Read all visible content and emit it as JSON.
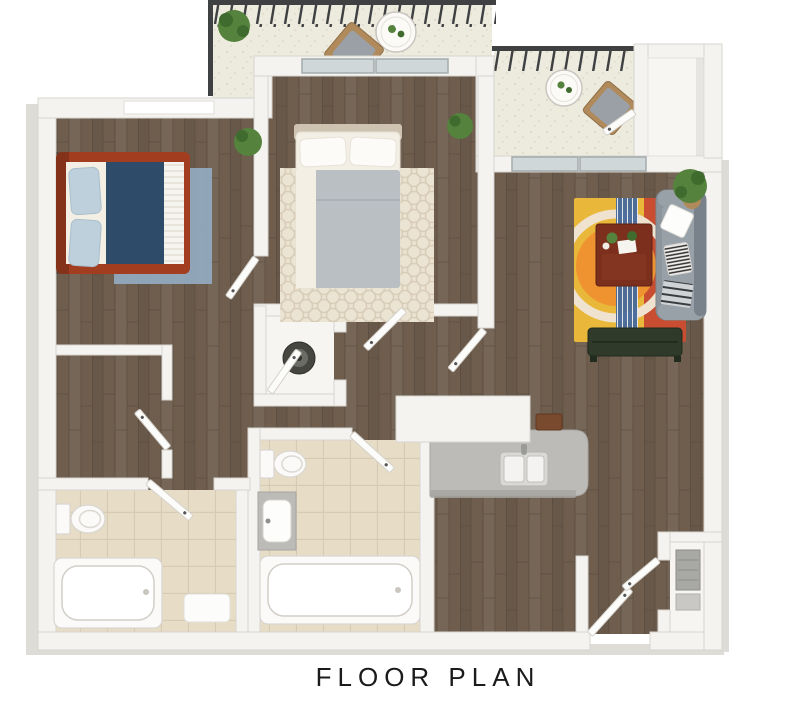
{
  "title": "FLOOR PLAN",
  "colors": {
    "wood": "#6f5e4e",
    "woodLine": "#57493d",
    "wall": "#f4f3f0",
    "wallEdge": "#d7d4cf",
    "skirt": "#dedcd7",
    "tile": "#e7ddc7",
    "tileLine": "#d6cbb2",
    "balconyFloor": "#edeade",
    "speckle": "#d2cdbc",
    "railing": "#3e4042",
    "glass": "#ccd4d6",
    "glassFrame": "#9ba4a6",
    "window": "#ffffff",
    "bedframe": "#a33d20",
    "navy": "#2e4c6a",
    "sheet": "#f3efe4",
    "pillowBlue": "#bdd0dc",
    "rugBlue": "#92a9be",
    "headboard": "#cdc3b0",
    "blanket": "#babfc4",
    "rugCream": "#ece4d3",
    "rugCreamLine": "#d8cdb8",
    "sofa": "#8d959c",
    "sofaDark": "#79828a",
    "sofaSeat": "#99a1a8",
    "zebra": "#2c2c2c",
    "rugYellow": "#e9b83a",
    "rugOrange": "#ee9330",
    "rugRed": "#c94e31",
    "rugStripe": "#46699b",
    "ringCream": "#efe3cf",
    "table": "#7c2f1d",
    "tableEdge": "#5e2314",
    "bench": "#2f3a2b",
    "benchEdge": "#212b1e",
    "counter": "#bcbbb7",
    "counterEdge": "#a6a5a1",
    "plant": "#55823c",
    "plantDark": "#3f6b2e",
    "washer": "#45463f",
    "door": "#fcfcfa",
    "doorEdge": "#d5d2cd",
    "white": "#fbfaf8",
    "fixtureEdge": "#d9d6d1",
    "potTan": "#b08a5a",
    "chairWood": "#b08a5a",
    "cushion": "#9aa0a5",
    "text": "#1b1b1b"
  }
}
